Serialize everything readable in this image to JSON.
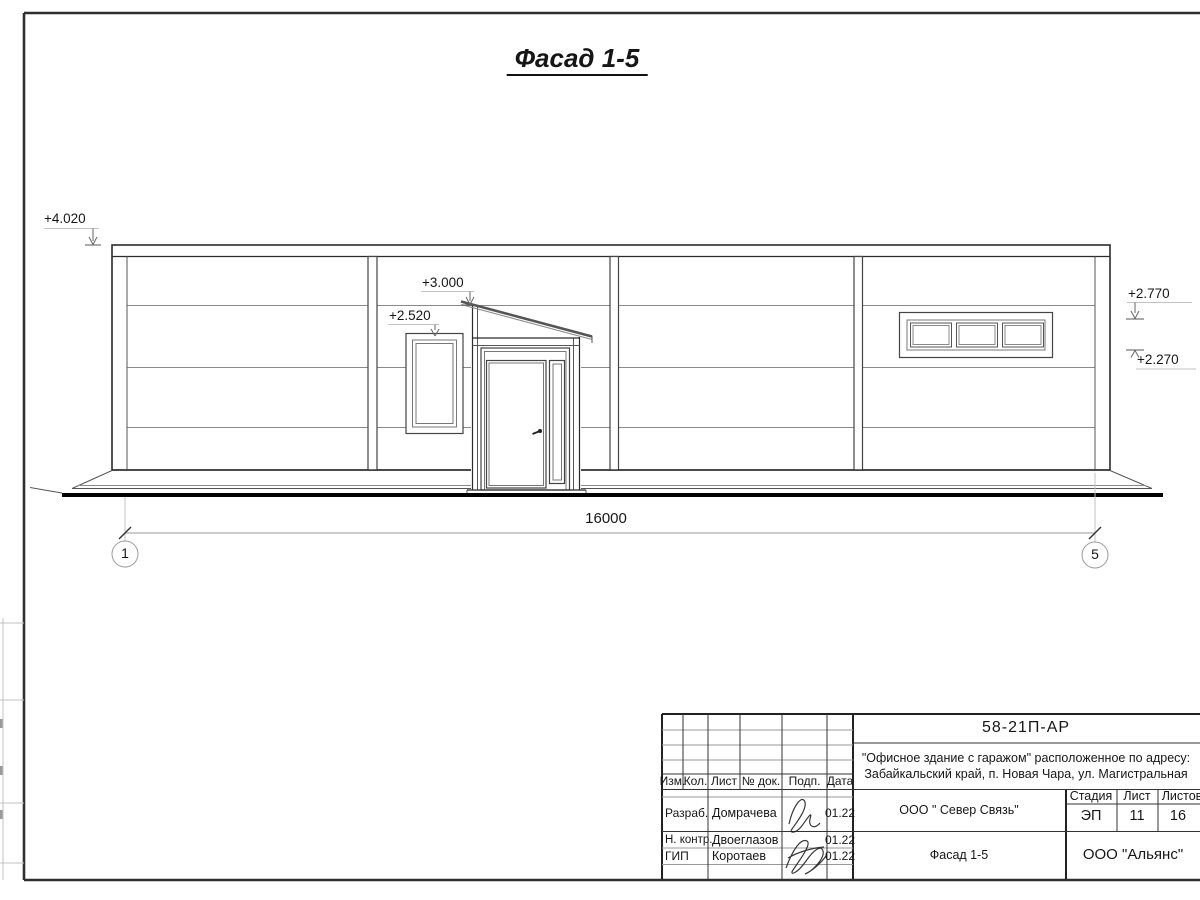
{
  "drawing": {
    "view_title": "Фасад 1-5",
    "dimension_total": "16000",
    "axis_left": "1",
    "axis_right": "5",
    "elev_parapet": "+4.020",
    "elev_canopy": "+3.000",
    "elev_window_head": "+2.520",
    "elev_ribbon_head": "+2.770",
    "elev_ribbon_sill": "+2.270"
  },
  "title_block": {
    "doc_number": "58-21П-АР",
    "project_line1": "\"Офисное здание с гаражом\" расположенное по адресу:",
    "project_line2": "Забайкальский край, п. Новая Чара, ул. Магистральная",
    "columns": {
      "izm": "Изм.",
      "kol": "Кол.",
      "list": "Лист",
      "doc": "№ док.",
      "podp": "Подп.",
      "data": "Дата"
    },
    "roles": [
      {
        "role": "Разраб.",
        "name": "Домрачева",
        "date": "01.22"
      },
      {
        "role": "Н. контр.",
        "name": "Двоеглазов",
        "date": "01.22"
      },
      {
        "role": "ГИП",
        "name": "Коротаев",
        "date": "01.22"
      }
    ],
    "client": "ООО \" Север Связь\"",
    "sheet_name": "Фасад 1-5",
    "company": "ООО \"Альянс\"",
    "stage_label": "Стадия",
    "sheet_label": "Лист",
    "sheets_label": "Листов",
    "stage": "ЭП",
    "sheet": "11",
    "sheets": "16"
  },
  "colors": {
    "line": "#2b2b2b",
    "thin_line": "#8a8a8a",
    "ground": "#000000",
    "paper": "#ffffff"
  }
}
